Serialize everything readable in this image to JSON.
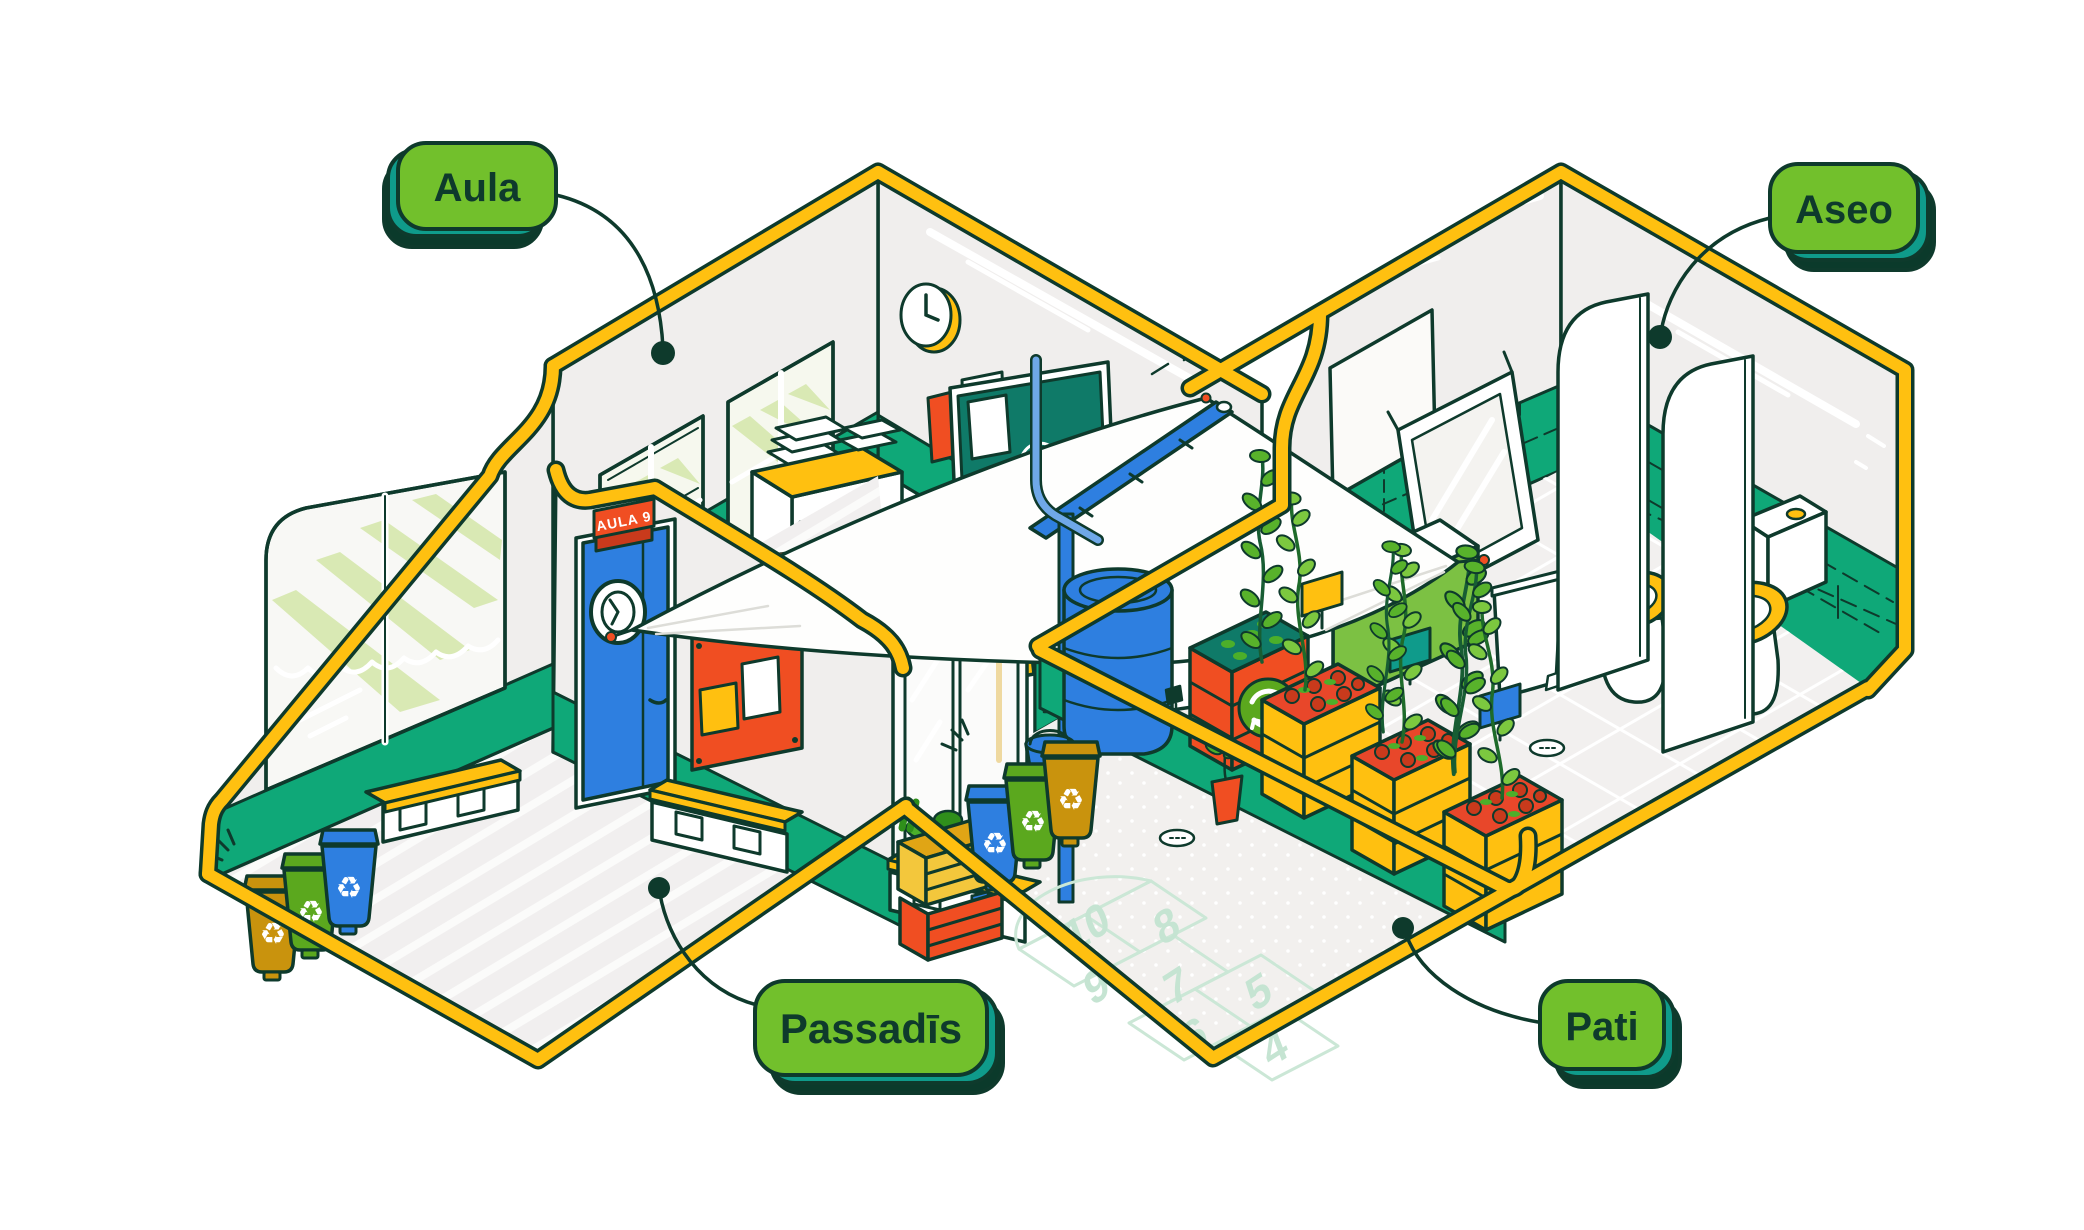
{
  "illustration": {
    "title": "School spaces isometric cutaway",
    "labels": {
      "aula": "Aula",
      "aseo": "Aseo",
      "passadis": "Passadīs",
      "pati": "Pati"
    },
    "classroom": {
      "door_sign": "AULA 9"
    },
    "patio": {
      "hopscotch_numbers": [
        "10",
        "8",
        "9",
        "7",
        "5",
        "6",
        "4"
      ]
    },
    "icons": [
      "recycle-icon",
      "clock-icon",
      "drain-icon",
      "porthole-icon",
      "chalk-circle-icon",
      "chalk-plus-icon",
      "sparkle-icon"
    ],
    "palette": {
      "outline": "#0E3A2C",
      "label_green": "#72C02C",
      "label_side_teal": "#0F9B8B",
      "label_shadow": "#0B3A2B",
      "trim_yellow": "#FFC010",
      "wall_teal": "#0FA878",
      "chalkboard_teal": "#0F7A68",
      "accent_blue": "#2E7FE0",
      "accent_orange": "#F04E22",
      "awning_green": "#D9E9B4",
      "bin_green": "#5BA81E",
      "bin_mustard": "#C9930D",
      "cabinet_green": "#7CC143",
      "wall_gray": "#F0EEED",
      "floor_gray": "#F1EFEF",
      "hopscotch_pale": "#C5E4D2"
    }
  }
}
